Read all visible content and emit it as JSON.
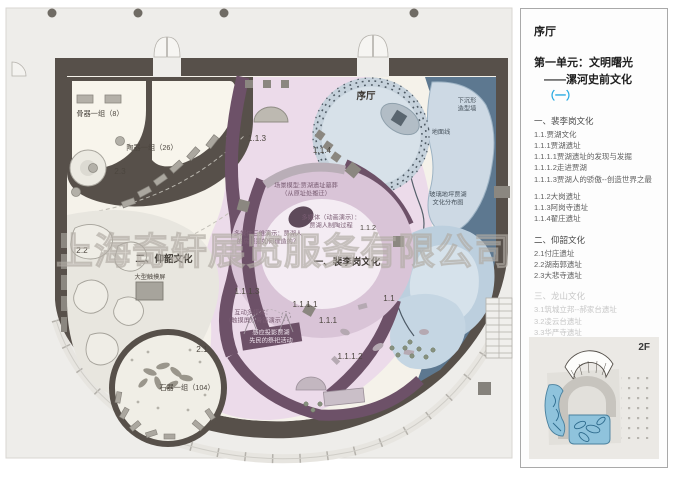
{
  "watermark": "上海奇轩展览服务有限公司",
  "palette": {
    "accent": "#29abe2",
    "wall": "#57504a",
    "purple-wall": "#6d5168",
    "pink": "#ecdbea",
    "pink-ring": "#d9c4d7",
    "pink-light": "#f4ecf3",
    "blue-dark": "#5d7890",
    "blue": "#bccfde",
    "blue-light": "#d6e2eb",
    "cream": "#f8f5ec",
    "floor": "#f5f2ea",
    "plate": "#eeedea",
    "gray-item": "#b0aca4",
    "thumb-blue": "#8fc3dc"
  },
  "plan": {
    "labels": {
      "bone_tools": "骨器一组（8）",
      "pottery": "陶器一组（26）",
      "zone_2_3": "2.3",
      "zone_2_2": "2.2",
      "unit2_title": "二、仰韶文化",
      "touch_screen": "大型触摸屏",
      "zone_2_1": "2.1",
      "stone_tools": "石器一组（104）",
      "hall_label": "序厅",
      "zone_1_1_3": "1.1.3",
      "zone_1_1_4": "1.1.4",
      "scene_model_l1": "场景模型:贾湖遗址墓葬",
      "scene_model_l2": "（从原址处搬迁）",
      "media_anim_l1": "多媒体（动画演示）：",
      "media_anim_l2": "贾湖人制陶过程",
      "zone_1_1_2": "1.1.2",
      "media_3d_l1": "多媒体三维演示：贾湖人",
      "media_3d_l2": "的房屋是如何建造的？",
      "unit1_title": "一、裴李岗文化",
      "zone_1_1_1_3": "1.1.1.3",
      "interactive_l1": "互动多媒体：",
      "interactive_l2": "（触摸屏）骨笛演示",
      "zone_1_1_1_1": "1.1.1.1",
      "zone_1_1_1": "1.1.1",
      "zone_1_1": "1.1",
      "projection_l1": "感应投影贾湖",
      "projection_l2": "先民的祭祀活动",
      "zone_1_1_1_2": "1.1.1.2",
      "sunken_wall_l1": "下沉形",
      "sunken_wall_l2": "造型墙",
      "ground_line": "地面线",
      "glass_floor_l1": "玻璃地坪贾湖",
      "glass_floor_l2": "文化分布图"
    }
  },
  "panel": {
    "hall_title": "序厅",
    "unit_title_line1": "第一单元：文明曙光",
    "unit_title_line2_prefix": "——漯河史前文化",
    "unit_title_line2_highlight": "（一）",
    "floor_label": "2F",
    "sections": [
      {
        "title": "一、裴李岗文化",
        "muted": false,
        "items": [
          "1.1.贾湖文化",
          "1.1.1贾湖遗址",
          "1.1.1.1贾湖遗址的发现与发掘",
          "1.1.1.2走进贾湖",
          "1.1.1.3贾湖人的骄傲--创造世界之最",
          "",
          "1.1.2大岗遗址",
          "1.1.3阿岗寺遗址",
          "1.1.4翟庄遗址"
        ]
      },
      {
        "title": "二、仰韶文化",
        "muted": false,
        "items": [
          "2.1付庄遗址",
          "2.2湖南郭遗址",
          "2.3大悲寺遗址"
        ]
      },
      {
        "title": "三、龙山文化",
        "muted": true,
        "items": [
          "3.1筑城立邦--郝家台遗址",
          "3.2凌云台遗址",
          "3.3华严寺遗址",
          "3.4漯河市其它龙山文化遗址"
        ]
      }
    ]
  }
}
